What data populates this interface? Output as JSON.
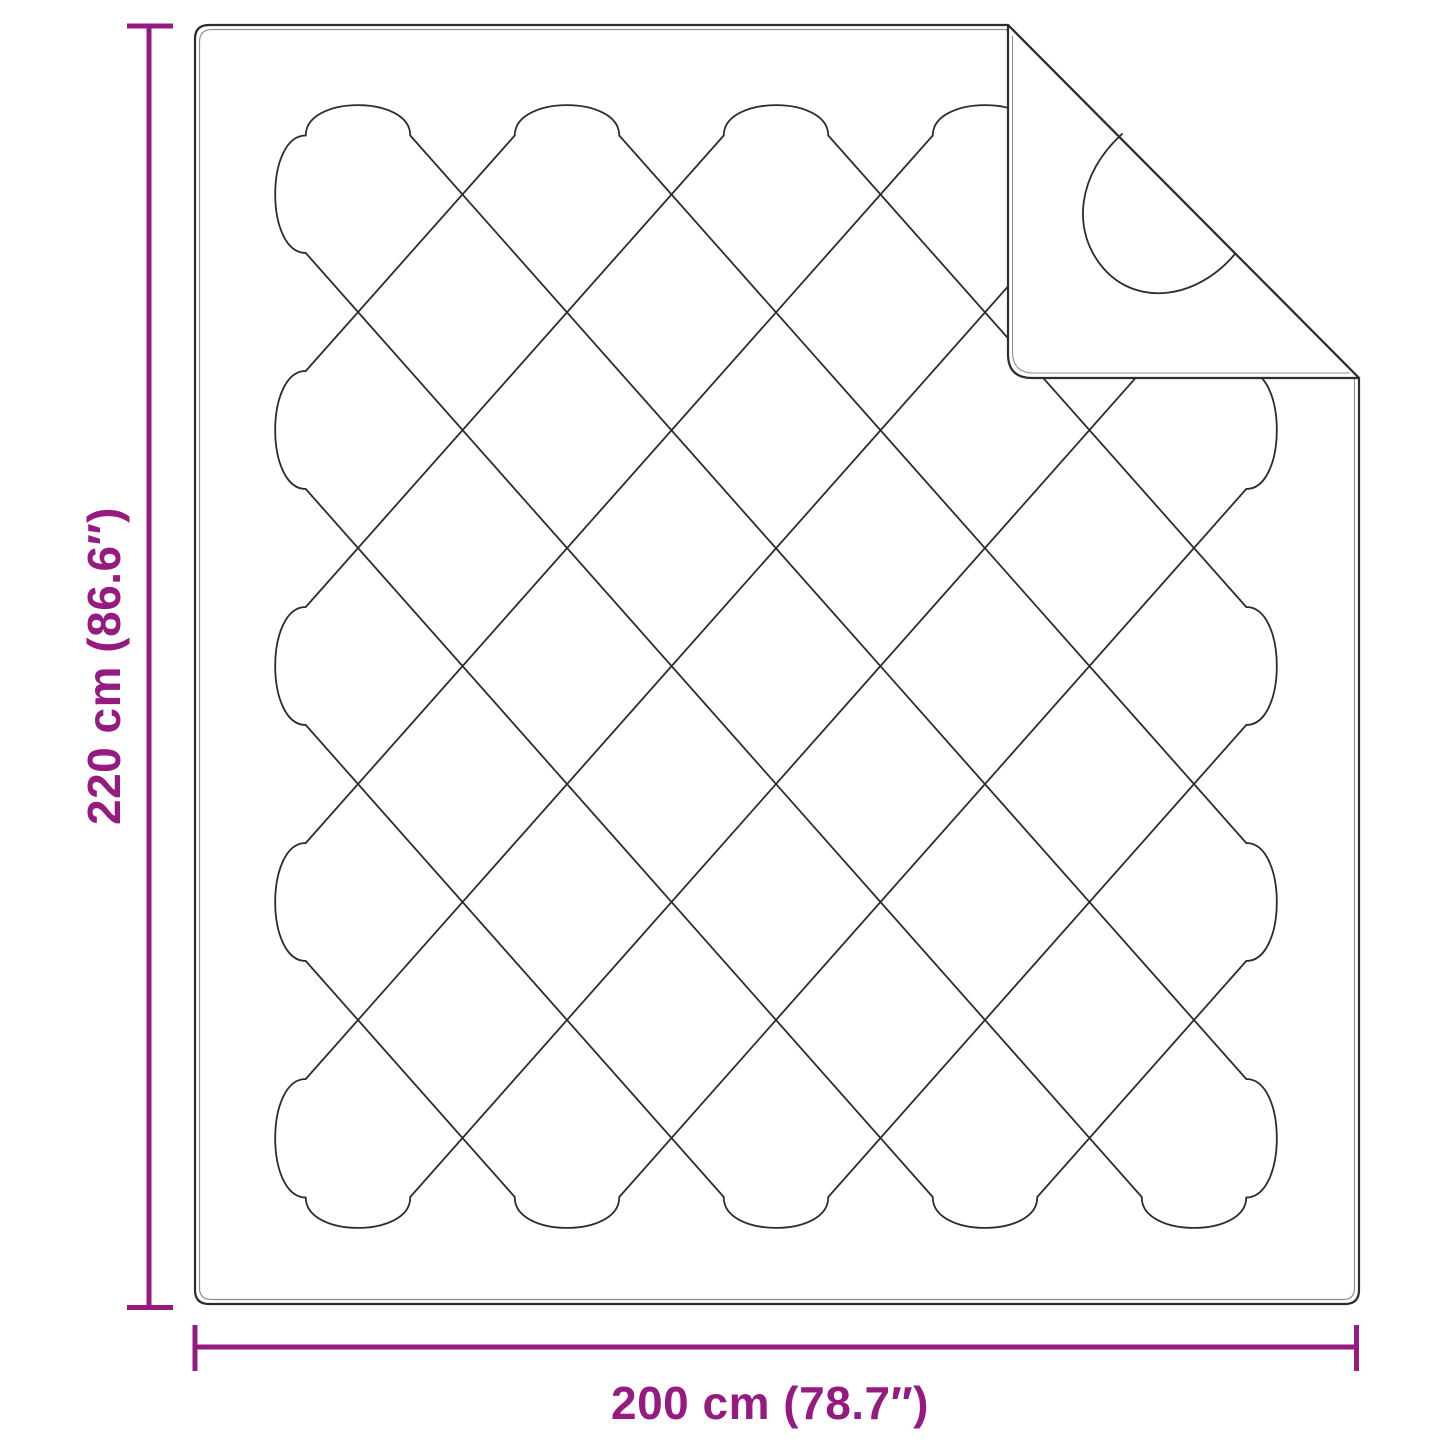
{
  "diagram": {
    "subject": "quilted-blanket-dimension-diagram",
    "vertical_dimension": {
      "label": "220 cm (86.6″)",
      "orientation": "vertical"
    },
    "horizontal_dimension": {
      "label": "200 cm (78.7″)",
      "orientation": "horizontal"
    },
    "colors": {
      "dimension_accent": "#951b81",
      "outline_dark": "#2d2d2d",
      "outline_light": "#8f8f8f",
      "background": "#ffffff"
    }
  }
}
